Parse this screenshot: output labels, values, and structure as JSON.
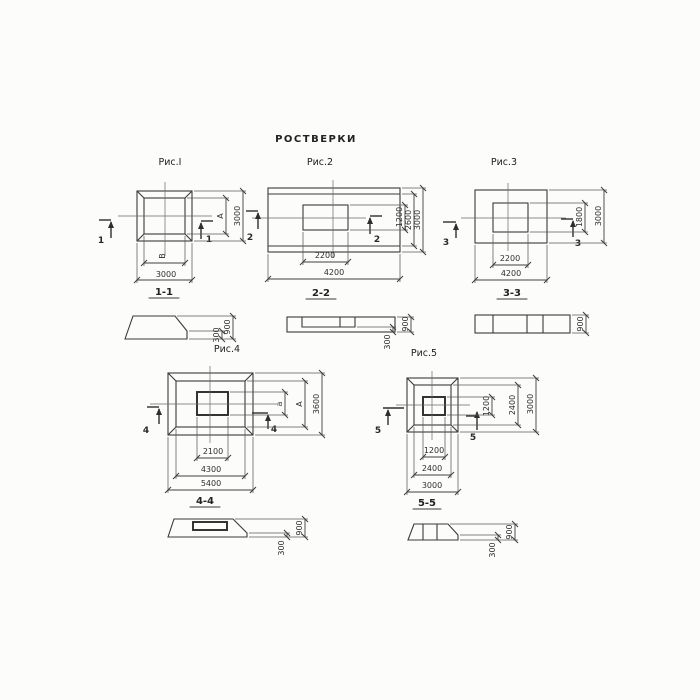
{
  "title": "РОСТВЕРКИ",
  "colors": {
    "background": "#fcfcfa",
    "line": "#3a3a3a",
    "text": "#2e2e2e"
  },
  "figures": [
    {
      "caption": "Рис.I",
      "cut_label": "1",
      "section_title": "1-1",
      "plan_dims": {
        "bottom_inner": "В",
        "bottom_outer": "3000",
        "right_inner": "А",
        "right_outer": "3000"
      },
      "section_dims": {
        "step": "300",
        "total": "900"
      }
    },
    {
      "caption": "Рис.2",
      "cut_label": "2",
      "section_title": "2-2",
      "plan_dims": {
        "bottom_inner": "2200",
        "bottom_outer": "4200",
        "right_inner": "1200",
        "right_middle": "2600",
        "right_outer": "3000"
      },
      "section_dims": {
        "step": "300",
        "total": "900"
      }
    },
    {
      "caption": "Рис.3",
      "cut_label": "3",
      "section_title": "3-3",
      "plan_dims": {
        "bottom_inner": "2200",
        "bottom_outer": "4200",
        "right_inner": "1800",
        "right_outer": "3000"
      },
      "section_dims": {
        "total": "900"
      }
    },
    {
      "caption": "Рис.4",
      "cut_label": "4",
      "section_title": "4-4",
      "plan_dims": {
        "bottom_inner": "2100",
        "bottom_middle": "4300",
        "bottom_outer": "5400",
        "right_inner": "а",
        "right_middle": "А",
        "right_outer": "3600"
      },
      "section_dims": {
        "step": "300",
        "total": "900"
      }
    },
    {
      "caption": "Рис.5",
      "cut_label": "5",
      "section_title": "5-5",
      "plan_dims": {
        "bottom_inner": "1200",
        "bottom_middle": "2400",
        "bottom_outer": "3000",
        "right_inner": "1200",
        "right_middle": "2400",
        "right_outer": "3000"
      },
      "section_dims": {
        "step": "300",
        "total": "900"
      }
    }
  ]
}
